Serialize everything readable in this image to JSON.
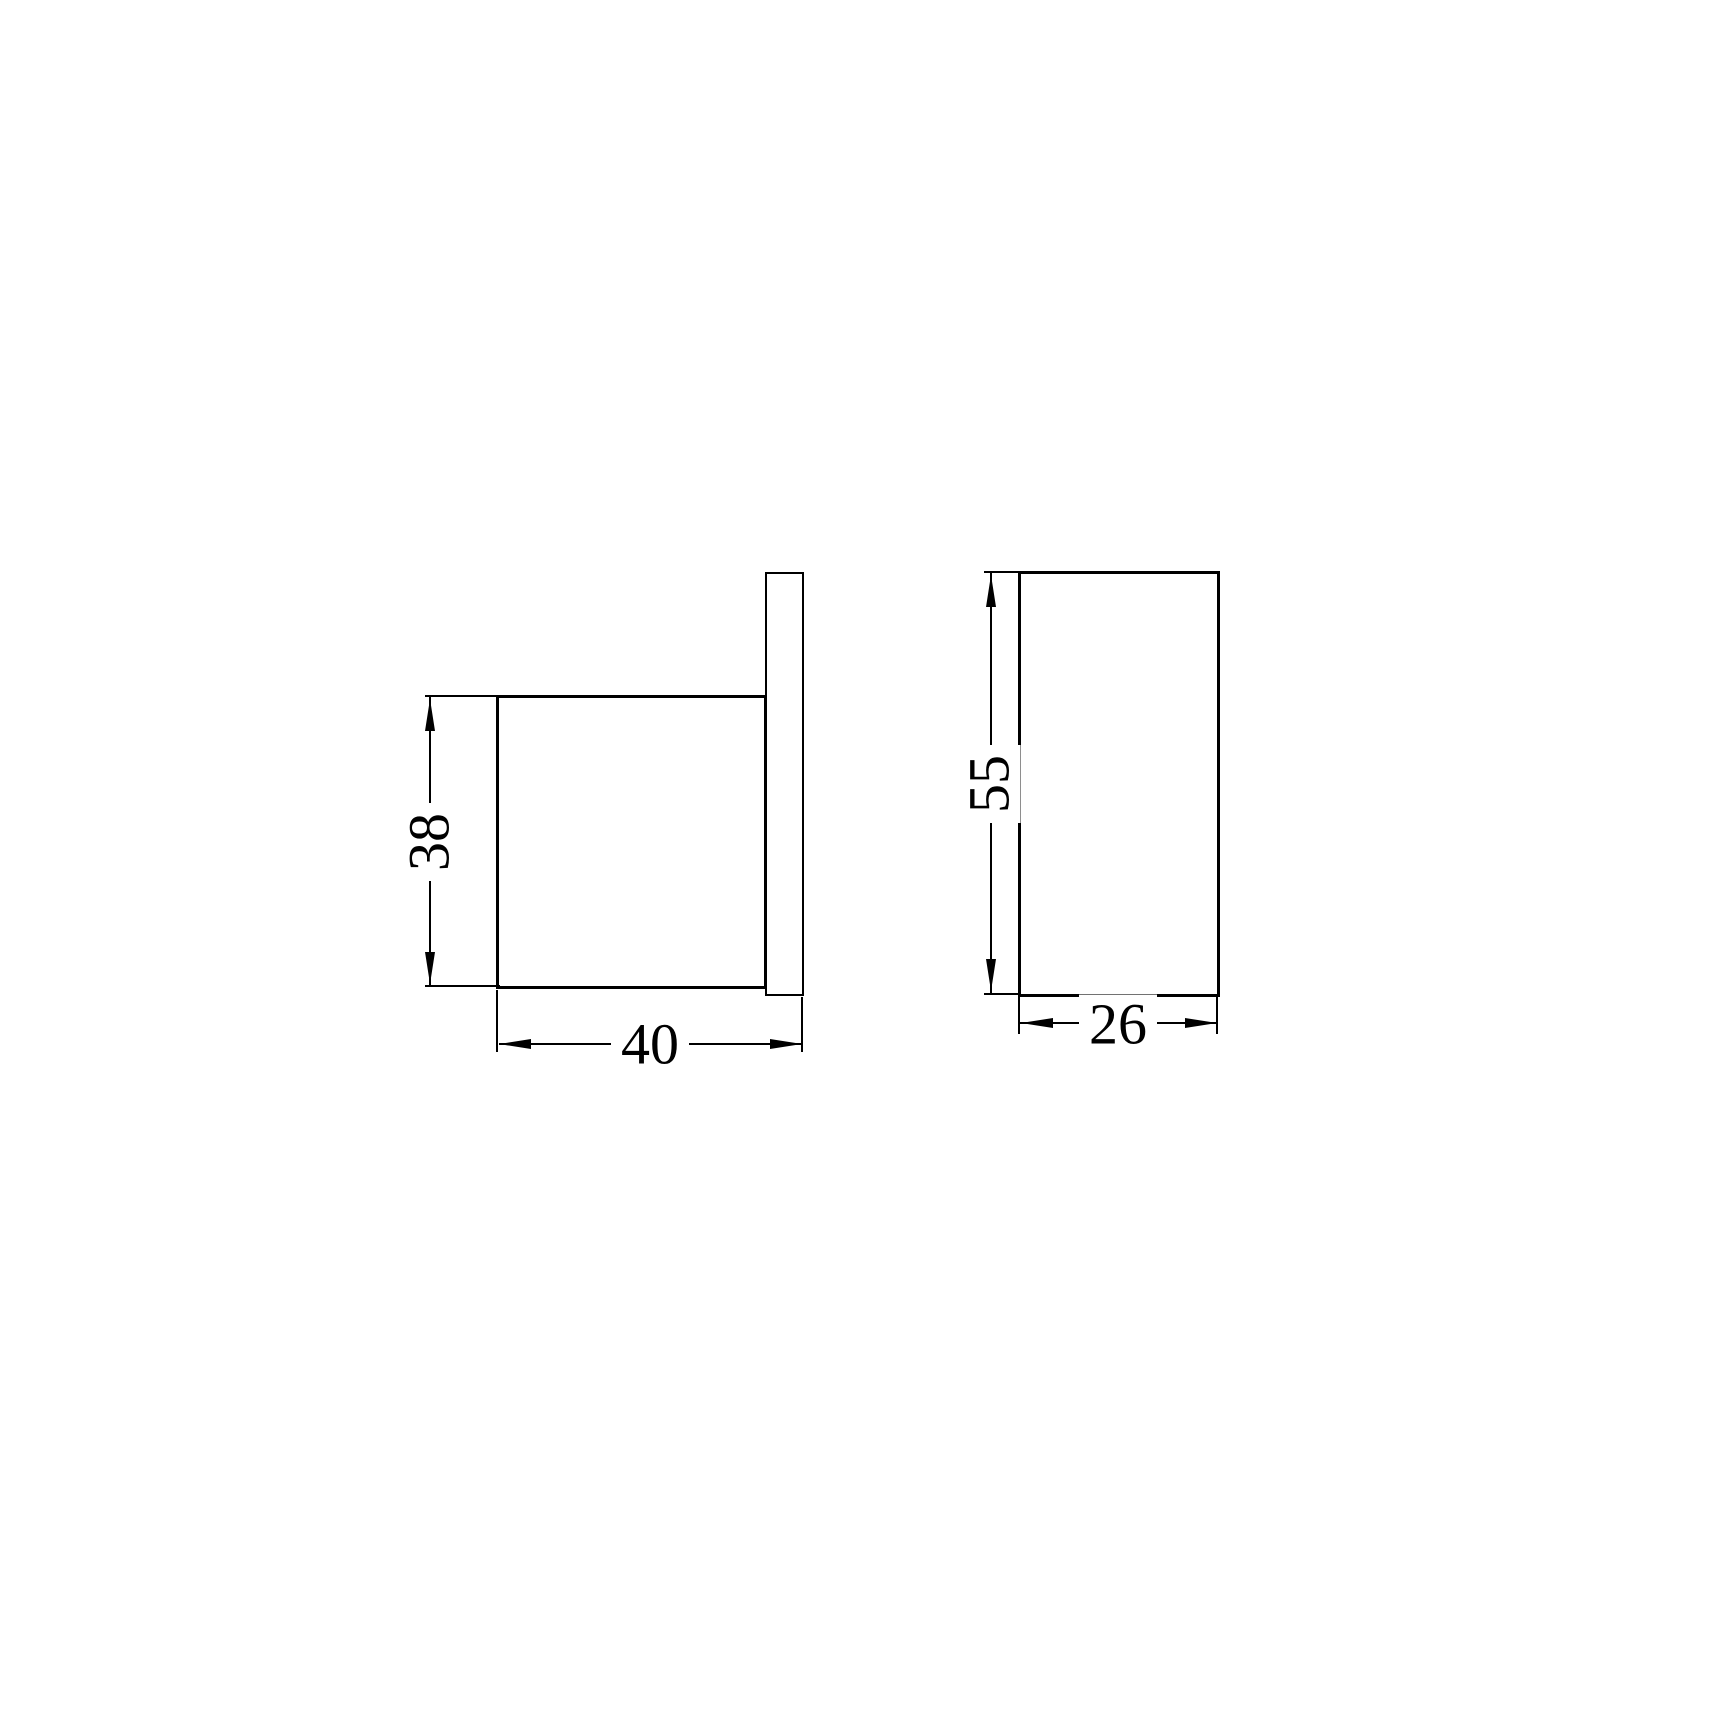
{
  "drawing": {
    "type": "technical-dimension-drawing",
    "background_color": "#ffffff",
    "line_color": "#000000",
    "views": {
      "side_view": {
        "description": "side profile of hook: square body on wall plate",
        "dimensions": {
          "height": {
            "label": "38"
          },
          "depth": {
            "label": "40"
          }
        }
      },
      "front_view": {
        "description": "front face rectangle",
        "dimensions": {
          "height": {
            "label": "55"
          },
          "width": {
            "label": "26"
          }
        }
      }
    }
  }
}
